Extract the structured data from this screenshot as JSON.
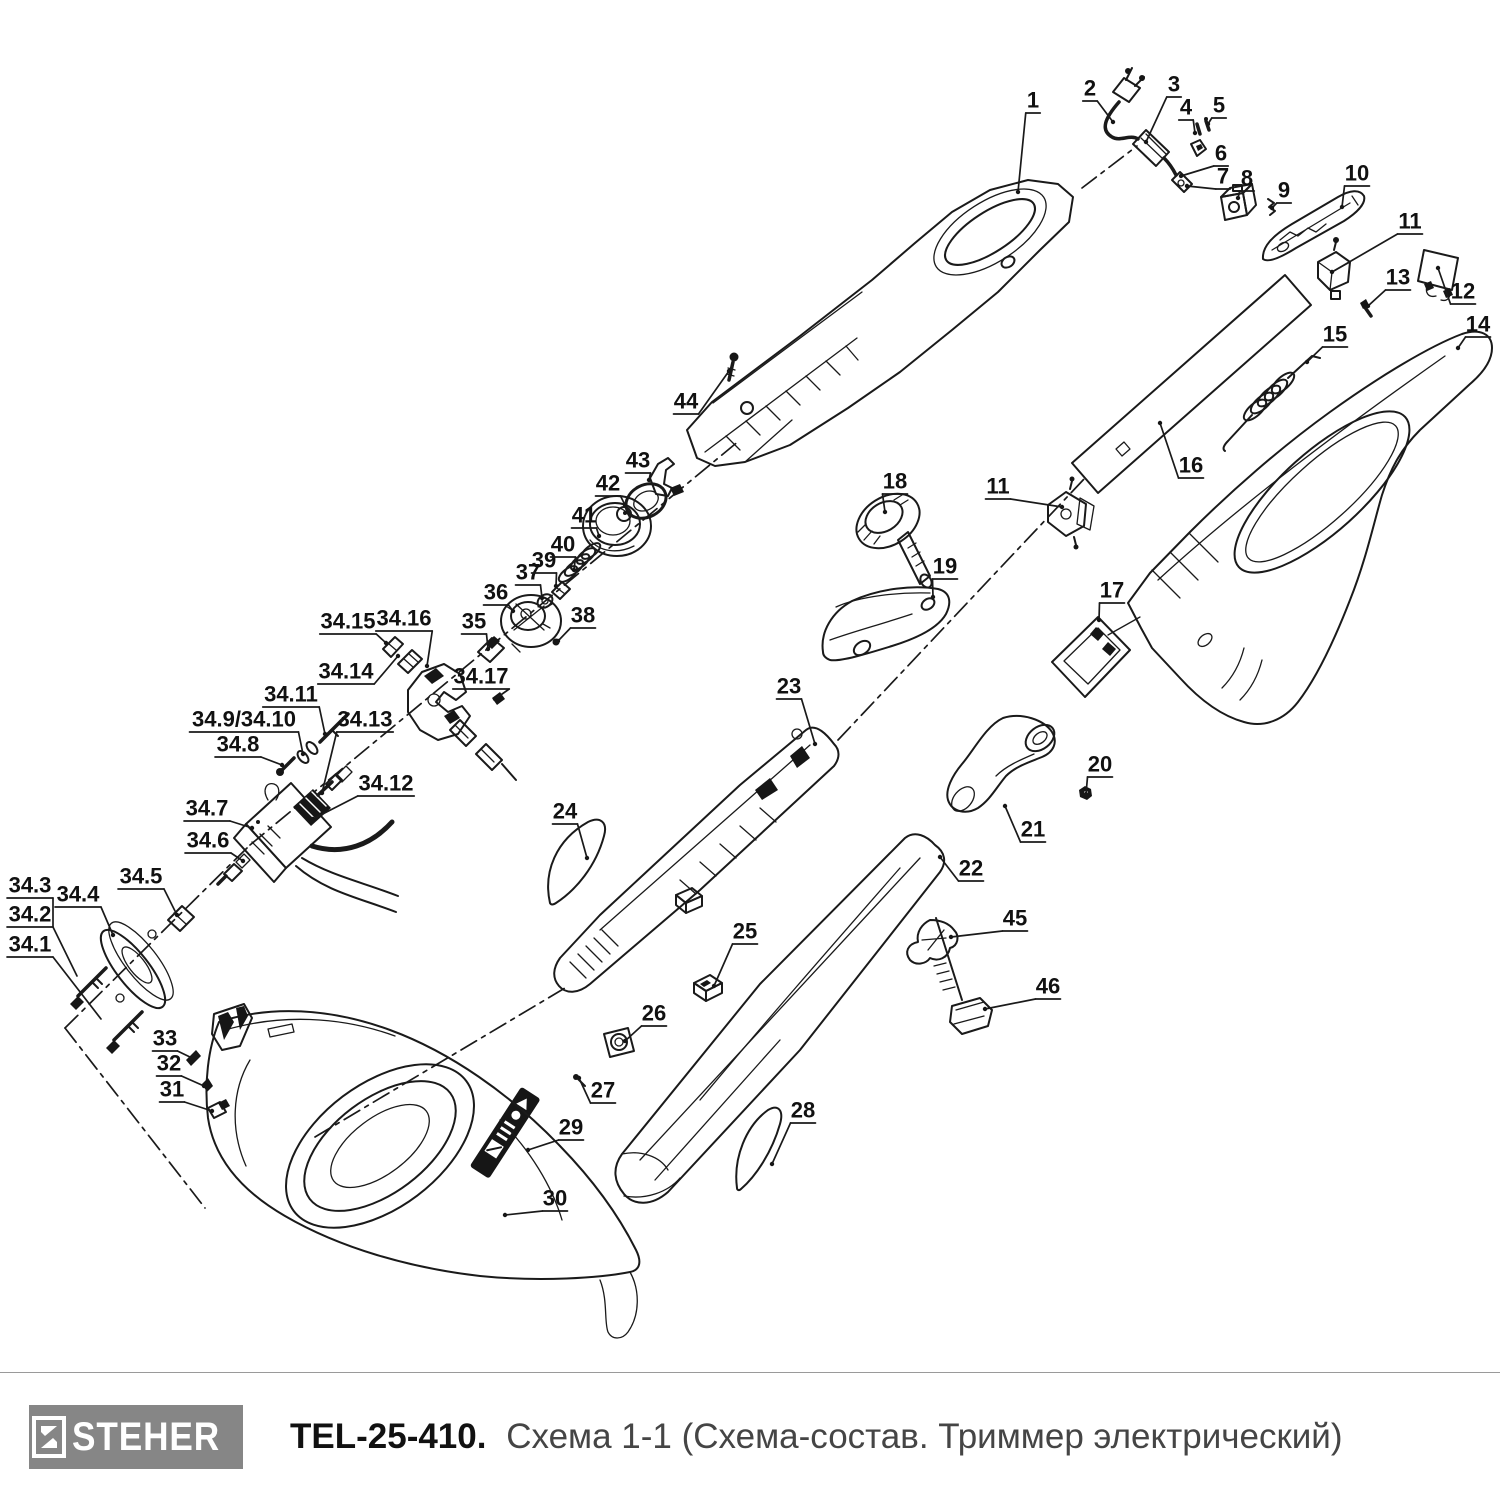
{
  "footer": {
    "brand": "STEHER",
    "model": "TEL-25-410.",
    "subtitle": "Схема 1-1 (Схема-состав. Триммер электрический)"
  },
  "diagram": {
    "stroke_color": "#1a1a1a",
    "labels": [
      {
        "t": "1",
        "x": 1033,
        "y": 100,
        "ex": 1018,
        "ey": 192
      },
      {
        "t": "2",
        "x": 1090,
        "y": 88,
        "ex": 1113,
        "ey": 122
      },
      {
        "t": "3",
        "x": 1174,
        "y": 84,
        "ex": 1146,
        "ey": 142
      },
      {
        "t": "4",
        "x": 1186,
        "y": 107,
        "ex": 1195,
        "ey": 133
      },
      {
        "t": "5",
        "x": 1219,
        "y": 105,
        "ex": 1208,
        "ey": 124
      },
      {
        "t": "6",
        "x": 1221,
        "y": 153,
        "ex": 1181,
        "ey": 176
      },
      {
        "t": "7",
        "x": 1223,
        "y": 176,
        "ex": 1187,
        "ey": 186
      },
      {
        "t": "8",
        "x": 1247,
        "y": 178,
        "ex": 1238,
        "ey": 198
      },
      {
        "t": "9",
        "x": 1284,
        "y": 190,
        "ex": 1272,
        "ey": 208
      },
      {
        "t": "10",
        "x": 1357,
        "y": 173,
        "ex": 1342,
        "ey": 207
      },
      {
        "t": "11",
        "x": 1410,
        "y": 221,
        "ex": 1332,
        "ey": 272
      },
      {
        "t": "12",
        "x": 1463,
        "y": 291,
        "ex": 1438,
        "ey": 268
      },
      {
        "t": "13",
        "x": 1398,
        "y": 277,
        "ex": 1368,
        "ey": 306
      },
      {
        "t": "14",
        "x": 1478,
        "y": 324,
        "ex": 1458,
        "ey": 348
      },
      {
        "t": "15",
        "x": 1335,
        "y": 334,
        "ex": 1307,
        "ey": 362
      },
      {
        "t": "16",
        "x": 1191,
        "y": 465,
        "ex": 1160,
        "ey": 423
      },
      {
        "t": "17",
        "x": 1112,
        "y": 590,
        "ex": 1099,
        "ey": 620
      },
      {
        "t": "18",
        "x": 895,
        "y": 481,
        "ex": 885,
        "ey": 512
      },
      {
        "t": "11",
        "x": 998,
        "y": 486,
        "ex": 1062,
        "ey": 507
      },
      {
        "t": "19",
        "x": 945,
        "y": 566,
        "ex": 933,
        "ey": 597
      },
      {
        "t": "20",
        "x": 1100,
        "y": 764,
        "ex": 1086,
        "ey": 794
      },
      {
        "t": "21",
        "x": 1033,
        "y": 829,
        "ex": 1005,
        "ey": 806
      },
      {
        "t": "22",
        "x": 971,
        "y": 868,
        "ex": 940,
        "ey": 857
      },
      {
        "t": "45",
        "x": 1015,
        "y": 918,
        "ex": 951,
        "ey": 937
      },
      {
        "t": "46",
        "x": 1048,
        "y": 986,
        "ex": 985,
        "ey": 1009
      },
      {
        "t": "23",
        "x": 789,
        "y": 686,
        "ex": 815,
        "ey": 744
      },
      {
        "t": "24",
        "x": 565,
        "y": 811,
        "ex": 587,
        "ey": 858
      },
      {
        "t": "25",
        "x": 745,
        "y": 931,
        "ex": 714,
        "ey": 986
      },
      {
        "t": "26",
        "x": 654,
        "y": 1013,
        "ex": 625,
        "ey": 1041
      },
      {
        "t": "27",
        "x": 603,
        "y": 1090,
        "ex": 579,
        "ey": 1078
      },
      {
        "t": "28",
        "x": 803,
        "y": 1110,
        "ex": 772,
        "ey": 1164
      },
      {
        "t": "29",
        "x": 571,
        "y": 1127,
        "ex": 528,
        "ey": 1150
      },
      {
        "t": "30",
        "x": 555,
        "y": 1198,
        "ex": 505,
        "ey": 1215
      },
      {
        "t": "31",
        "x": 172,
        "y": 1089,
        "ex": 212,
        "ey": 1111
      },
      {
        "t": "32",
        "x": 169,
        "y": 1063,
        "ex": 204,
        "ey": 1086
      },
      {
        "t": "33",
        "x": 165,
        "y": 1038,
        "ex": 192,
        "ey": 1058
      },
      {
        "t": "34.1",
        "x": 30,
        "y": 944
      },
      {
        "t": "34.2",
        "x": 30,
        "y": 914
      },
      {
        "t": "34.3",
        "x": 30,
        "y": 885
      },
      {
        "t": "34.4",
        "x": 78,
        "y": 894,
        "ex": 113,
        "ey": 935
      },
      {
        "t": "34.5",
        "x": 141,
        "y": 876,
        "ex": 177,
        "ey": 915
      },
      {
        "t": "34.6",
        "x": 208,
        "y": 840,
        "ex": 243,
        "ey": 861
      },
      {
        "t": "34.7",
        "x": 207,
        "y": 808,
        "ex": 252,
        "ey": 828
      },
      {
        "t": "34.8",
        "x": 238,
        "y": 744,
        "ex": 282,
        "ey": 765
      },
      {
        "t": "34.9/34.10",
        "x": 244,
        "y": 719,
        "ex": 303,
        "ey": 754
      },
      {
        "t": "34.11",
        "x": 291,
        "y": 694,
        "ex": 325,
        "ey": 734
      },
      {
        "t": "34.12",
        "x": 386,
        "y": 783,
        "ex": 313,
        "ey": 819
      },
      {
        "t": "34.13",
        "x": 365,
        "y": 719,
        "ex": 322,
        "ey": 793
      },
      {
        "t": "34.14",
        "x": 346,
        "y": 671,
        "ex": 398,
        "ey": 656
      },
      {
        "t": "34.15",
        "x": 348,
        "y": 621,
        "ex": 386,
        "ey": 643
      },
      {
        "t": "34.16",
        "x": 404,
        "y": 618,
        "ex": 427,
        "ey": 666
      },
      {
        "t": "34.17",
        "x": 481,
        "y": 676,
        "ex": 495,
        "ey": 699
      },
      {
        "t": "35",
        "x": 474,
        "y": 621,
        "ex": 488,
        "ey": 649
      },
      {
        "t": "36",
        "x": 496,
        "y": 592,
        "ex": 513,
        "ey": 611
      },
      {
        "t": "37",
        "x": 528,
        "y": 572,
        "ex": 542,
        "ey": 598
      },
      {
        "t": "38",
        "x": 583,
        "y": 615,
        "ex": 558,
        "ey": 641
      },
      {
        "t": "39",
        "x": 544,
        "y": 560,
        "ex": 556,
        "ey": 586
      },
      {
        "t": "40",
        "x": 563,
        "y": 544,
        "ex": 574,
        "ey": 570
      },
      {
        "t": "41",
        "x": 584,
        "y": 515,
        "ex": 599,
        "ey": 536
      },
      {
        "t": "42",
        "x": 608,
        "y": 483,
        "ex": 625,
        "ey": 505
      },
      {
        "t": "43",
        "x": 638,
        "y": 460,
        "ex": 649,
        "ey": 480
      },
      {
        "t": "44",
        "x": 686,
        "y": 401,
        "ex": 729,
        "ey": 371
      }
    ],
    "extra_lines": [
      [
        [
          53,
          898
        ],
        [
          53,
          927
        ]
      ],
      [
        [
          53,
          927
        ],
        [
          77,
          976
        ]
      ],
      [
        [
          53,
          957
        ],
        [
          101,
          1019
        ]
      ]
    ],
    "axes": [
      [
        [
          65,
          1028
        ],
        [
          250,
          845
        ]
      ],
      [
        [
          250,
          845
        ],
        [
          740,
          440
        ]
      ],
      [
        [
          65,
          1028
        ],
        [
          205,
          1208
        ]
      ],
      [
        [
          315,
          1137
        ],
        [
          565,
          988
        ]
      ],
      [
        [
          838,
          740
        ],
        [
          1085,
          478
        ]
      ],
      [
        [
          1082,
          188
        ],
        [
          1137,
          146
        ]
      ]
    ]
  }
}
